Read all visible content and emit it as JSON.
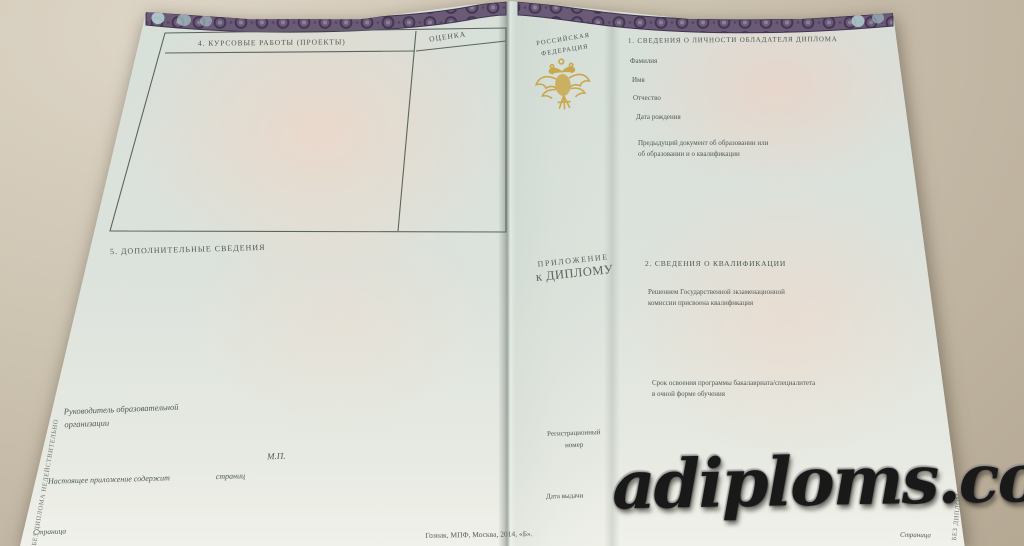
{
  "colors": {
    "surface": "#c9bfae",
    "paper": "#dce3dc",
    "ink": "#4e5a55",
    "band_base": "#6a5a76",
    "band_dark": "#443753",
    "band_light_accent": "#b9d6d6",
    "emblem_gold": "#c8a23c",
    "watermark": "#191919"
  },
  "left_page": {
    "table": {
      "title": "4. КУРСОВЫЕ РАБОТЫ (ПРОЕКТЫ)",
      "grade_column": "ОЦЕНКА"
    },
    "section5_title": "5. ДОПОЛНИТЕЛЬНЫЕ СВЕДЕНИЯ",
    "head_line1": "Руководитель образовательной",
    "head_line2": "организации",
    "seal_label": "М.П.",
    "contains_label": "Настоящее приложение содержит",
    "pages_label": "страниц",
    "page_label": "Страница",
    "edge_note": "БЕЗ ДИПЛОМА НЕДЕЙСТВИТЕЛЬНО"
  },
  "center": {
    "country_line1": "РОССИЙСКАЯ",
    "country_line2": "ФЕДЕРАЦИЯ",
    "emblem_name": "russian-coat-of-arms",
    "title_line1": "ПРИЛОЖЕНИЕ",
    "title_line2": "к ДИПЛОМУ",
    "reg_line1": "Регистрационный",
    "reg_line2": "номер",
    "date_label": "Дата выдачи",
    "print_note": "Гознак, МПФ, Москва, 2014, «Б»."
  },
  "right_page": {
    "section1_title": "1. СВЕДЕНИЯ О ЛИЧНОСТИ ОБЛАДАТЕЛЯ ДИПЛОМА",
    "fields": [
      "Фамилия",
      "Имя",
      "Отчество",
      "Дата рождения"
    ],
    "prev_doc_line1": "Предыдущий документ об образовании или",
    "prev_doc_line2": "об образовании и о квалификации",
    "section2_title": "2. СВЕДЕНИЯ О КВАЛИФИКАЦИИ",
    "decision_line1": "Решением Государственной экзаменационной",
    "decision_line2": "комиссии присвоена квалификация",
    "duration_line1": "Срок освоения программы бакалавриата/специалитета",
    "duration_line2": "в очной форме обучения",
    "page_label": "Страница",
    "edge_note": "БЕЗ ДИПЛОМА НЕДЕЙСТВИТЕЛЬНО"
  },
  "watermark": {
    "text": "adiploms.com"
  }
}
